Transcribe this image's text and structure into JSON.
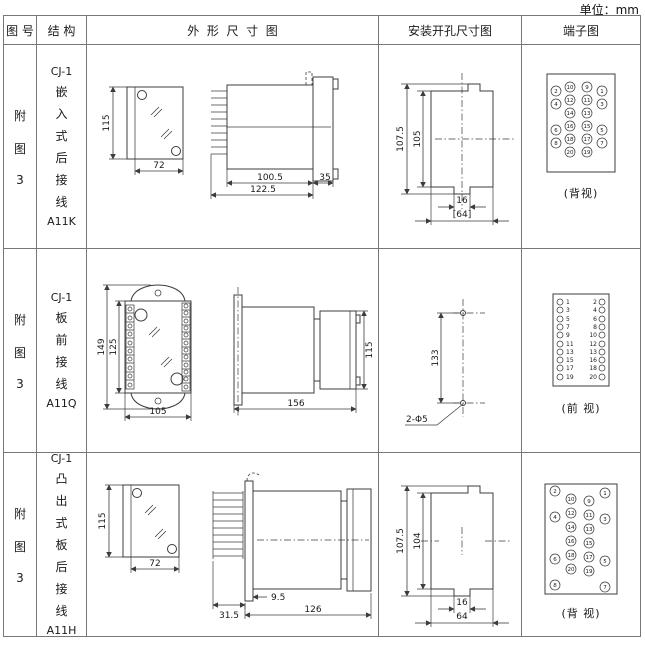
{
  "unit": "单位：mm",
  "headers": {
    "fig": "图 号",
    "struct": "结 构",
    "outline": "外  形  尺  寸  图",
    "install": "安装开孔尺寸图",
    "terminal": "端子图"
  },
  "rows": [
    {
      "fig": [
        "附",
        "图",
        "3"
      ],
      "structure": [
        "CJ-1",
        "嵌",
        "入",
        "式",
        "后",
        "接",
        "线",
        "A11K"
      ],
      "outline": {
        "front": {
          "height": "115",
          "width": "72"
        },
        "side": {
          "body_len": "100.5",
          "total_len": "122.5",
          "bezel": "35"
        }
      },
      "install": {
        "total_h": "107.5",
        "opening_h": "105",
        "notch_w": "16",
        "opening_w": "[64]"
      },
      "terminal": {
        "outer_left": [
          "2",
          "4",
          "6",
          "8"
        ],
        "inner_left": [
          "10",
          "12",
          "14",
          "16",
          "18",
          "20"
        ],
        "inner_right": [
          "9",
          "11",
          "13",
          "15",
          "17",
          "19"
        ],
        "outer_right": [
          "1",
          "3",
          "5",
          "7"
        ],
        "caption": "(背视)"
      }
    },
    {
      "fig": [
        "附",
        "图",
        "3"
      ],
      "structure": [
        "CJ-1",
        "板",
        "前",
        "接",
        "线",
        "A11Q"
      ],
      "outline": {
        "front": {
          "total_h": "149",
          "case_h": "125",
          "width": "105"
        },
        "side": {
          "total_len": "156",
          "height": "115"
        }
      },
      "install": {
        "hole_spacing": "133",
        "holes": "2-Φ5"
      },
      "terminal": {
        "left": [
          "1",
          "3",
          "5",
          "7",
          "9",
          "11",
          "13",
          "15",
          "17",
          "19"
        ],
        "right": [
          "2",
          "4",
          "6",
          "8",
          "10",
          "12",
          "13",
          "16",
          "18",
          "20"
        ],
        "caption": "(前 视)"
      }
    },
    {
      "fig": [
        "附",
        "图",
        "3"
      ],
      "structure": [
        "CJ-1",
        "凸",
        "出",
        "式",
        "板",
        "后",
        "接",
        "线",
        "A11H"
      ],
      "outline": {
        "front": {
          "height": "115",
          "width": "72"
        },
        "side": {
          "pin_len": "31.5",
          "offset": "9.5",
          "body_len": "126"
        }
      },
      "install": {
        "total_h": "107.5",
        "opening_h": "104",
        "notch_w": "16",
        "opening_w": "64"
      },
      "terminal": {
        "outer_left": [
          "2",
          "4",
          "6",
          "8"
        ],
        "inner_left": [
          "10",
          "12",
          "14",
          "16",
          "18",
          "20"
        ],
        "inner_right": [
          "9",
          "11",
          "13",
          "15",
          "17",
          "19"
        ],
        "outer_right": [
          "1",
          "3",
          "5",
          "7"
        ],
        "caption": "(背 视)"
      }
    }
  ]
}
